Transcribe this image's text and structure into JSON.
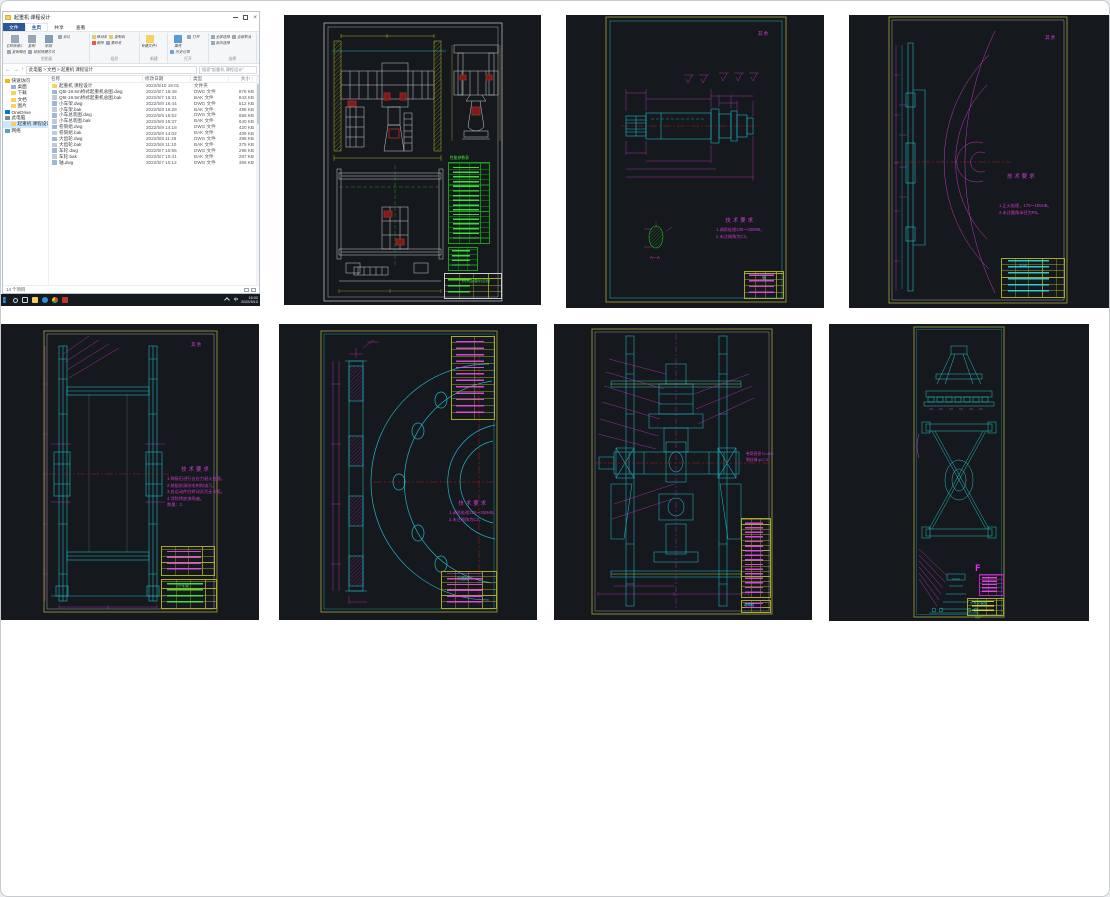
{
  "explorer": {
    "title": "起重机 课程设计",
    "controls": {
      "minimize": "–",
      "maximize": "□",
      "close": "×"
    },
    "ribbon": {
      "tabs": [
        {
          "label": "文件",
          "file": true
        },
        {
          "label": "主页",
          "active": true
        },
        {
          "label": "共享"
        },
        {
          "label": "查看"
        }
      ],
      "groups": [
        {
          "label": "剪贴板",
          "buttons": [
            {
              "label": "固定到快速访问",
              "icon": "pin-icon",
              "big": true
            },
            {
              "label": "复制",
              "icon": "copy-icon",
              "big": true
            },
            {
              "label": "粘贴",
              "icon": "paste-icon",
              "big": true
            },
            {
              "label": "剪切",
              "icon": "cut-icon"
            },
            {
              "label": "复制路径",
              "icon": "copy-path-icon"
            },
            {
              "label": "粘贴快捷方式",
              "icon": "paste-shortcut-icon"
            }
          ]
        },
        {
          "label": "组织",
          "buttons": [
            {
              "label": "移动到",
              "icon": "move-to-icon"
            },
            {
              "label": "复制到",
              "icon": "copy-to-icon"
            },
            {
              "label": "删除",
              "icon": "delete-icon"
            },
            {
              "label": "重命名",
              "icon": "rename-icon"
            }
          ]
        },
        {
          "label": "新建",
          "buttons": [
            {
              "label": "新建文件夹",
              "icon": "new-folder-icon",
              "big": true
            }
          ]
        },
        {
          "label": "打开",
          "buttons": [
            {
              "label": "属性",
              "icon": "properties-icon",
              "big": true
            },
            {
              "label": "打开",
              "icon": "open-icon"
            },
            {
              "label": "历史记录",
              "icon": "history-icon"
            }
          ]
        },
        {
          "label": "选择",
          "buttons": [
            {
              "label": "全部选择",
              "icon": "select-all-icon"
            },
            {
              "label": "全部取消",
              "icon": "select-none-icon"
            },
            {
              "label": "反向选择",
              "icon": "invert-selection-icon"
            }
          ]
        }
      ]
    },
    "address": {
      "back": "←",
      "forward": "→",
      "up": "↑",
      "breadcrumb": "此电脑 > 文档 > 起重机 课程设计",
      "search_placeholder": "搜索\"起重机 课程设计\""
    },
    "columns": {
      "name": "名称",
      "date": "修改日期",
      "type": "类型",
      "size": "大小"
    },
    "sidebar": [
      {
        "label": "快速访问",
        "kind": "quick",
        "lvl": 0
      },
      {
        "label": "桌面",
        "kind": "desktop",
        "lvl": 1
      },
      {
        "label": "下载",
        "kind": "folder",
        "lvl": 1
      },
      {
        "label": "文档",
        "kind": "folder",
        "lvl": 1
      },
      {
        "label": "图片",
        "kind": "folder",
        "lvl": 1
      },
      {
        "label": "OneDrive",
        "kind": "onedrive",
        "lvl": 0
      },
      {
        "label": "此电脑",
        "kind": "pc",
        "lvl": 0
      },
      {
        "label": "起重机 课程设计",
        "kind": "folder",
        "lvl": 1,
        "selected": true
      },
      {
        "label": "网络",
        "kind": "net",
        "lvl": 0
      }
    ],
    "files": [
      {
        "name": "起重机 课程设计",
        "date": "2022/5/10 16:01",
        "type": "文件夹",
        "size": "",
        "kind": "folder"
      },
      {
        "name": "Q5t-19.5m桥式起重机总图.dwg",
        "date": "2022/5/7 16:48",
        "type": "DWG 文件",
        "size": "876 KB",
        "kind": "dwg"
      },
      {
        "name": "Q5t-19.5m桥式起重机总图.bak",
        "date": "2022/5/7 16:31",
        "type": "BAK 文件",
        "size": "843 KB",
        "kind": "bak"
      },
      {
        "name": "小车架.dwg",
        "date": "2022/5/8 16:44",
        "type": "DWG 文件",
        "size": "512 KB",
        "kind": "dwg"
      },
      {
        "name": "小车架.bak",
        "date": "2022/5/8 16:29",
        "type": "BAK 文件",
        "size": "498 KB",
        "kind": "bak"
      },
      {
        "name": "小车总装图.dwg",
        "date": "2022/5/9 15:52",
        "type": "DWG 文件",
        "size": "655 KB",
        "kind": "dwg"
      },
      {
        "name": "小车总装图.bak",
        "date": "2022/5/9 15:37",
        "type": "BAK 文件",
        "size": "640 KB",
        "kind": "bak"
      },
      {
        "name": "卷筒组.dwg",
        "date": "2022/5/9 14:18",
        "type": "DWG 文件",
        "size": "420 KB",
        "kind": "dwg"
      },
      {
        "name": "卷筒组.bak",
        "date": "2022/5/9 14:02",
        "type": "BAK 文件",
        "size": "409 KB",
        "kind": "bak"
      },
      {
        "name": "大齿轮.dwg",
        "date": "2022/5/8 11:26",
        "type": "DWG 文件",
        "size": "388 KB",
        "kind": "dwg"
      },
      {
        "name": "大齿轮.bak",
        "date": "2022/5/8 11:10",
        "type": "BAK 文件",
        "size": "375 KB",
        "kind": "bak"
      },
      {
        "name": "车轮.dwg",
        "date": "2022/5/7 10:55",
        "type": "DWG 文件",
        "size": "298 KB",
        "kind": "dwg"
      },
      {
        "name": "车轮.bak",
        "date": "2022/5/7 10:41",
        "type": "BAK 文件",
        "size": "287 KB",
        "kind": "bak"
      },
      {
        "name": "轴.dwg",
        "date": "2022/5/7 10:12",
        "type": "DWG 文件",
        "size": "356 KB",
        "kind": "dwg"
      }
    ],
    "status": "14 个项目"
  },
  "taskbar": {
    "icons": [
      {
        "kind": "start",
        "name": "start-icon"
      },
      {
        "kind": "search",
        "name": "search-icon"
      },
      {
        "kind": "taskview",
        "name": "task-view-icon"
      },
      {
        "kind": "explorer",
        "name": "file-explorer-icon"
      },
      {
        "kind": "edge",
        "name": "edge-browser-icon"
      },
      {
        "kind": "chrome",
        "name": "chrome-browser-icon"
      },
      {
        "kind": "cad",
        "name": "autocad-icon"
      }
    ],
    "lang": "中",
    "time": "16:02",
    "date": "2022/5/10"
  },
  "tiles": {
    "bridge": {
      "bom_title": "性能参数表",
      "title_block": "桥式起重机总图"
    },
    "shaft": {
      "corner": "其余",
      "tech_title": "技术要求",
      "notes": [
        "1.调质处理220～250HB。",
        "2.未注倒角为C2。"
      ],
      "section_label": "A—A",
      "title_block": "轴"
    },
    "wheel": {
      "corner": "其余",
      "tech_title": "技术要求",
      "notes": [
        "1.正火处理，170～195HB。",
        "2.未注圆角半径为R5。"
      ],
      "title_block": "车轮"
    },
    "frame": {
      "corner": "其余",
      "tech_title": "技术要求",
      "notes": [
        "1.焊接后进行去应力退火处理。",
        "2.装配前清除毛刺和油污。",
        "3.各运动件应转动灵活无卡阻。",
        "4.涂防锈底漆两遍。",
        "数量：2"
      ],
      "title_block": "小车架"
    },
    "gear": {
      "tech_title": "技术要求",
      "notes": [
        "1.调质处理220～250HB。",
        "2.未注倒角为C2。"
      ],
      "title_block": "大齿轮"
    },
    "drum": {
      "side_notes": [
        "卷筒直径 D=400",
        "钢丝绳 φ17.5"
      ],
      "title_block": "卷筒组"
    },
    "trolley": {
      "detail_mark": "F",
      "title_block": "小车总装图"
    }
  },
  "colors": {
    "cad_background": "#15181c",
    "cad_cyan": "#1fb6c4",
    "cad_magenta": "#c437c4",
    "cad_red": "#9b2323",
    "cad_yellow": "#b5b526",
    "cad_green": "#23b523",
    "cad_white": "#c9ced3",
    "taskbar": "#151a21",
    "selection": "#cce8ff"
  }
}
